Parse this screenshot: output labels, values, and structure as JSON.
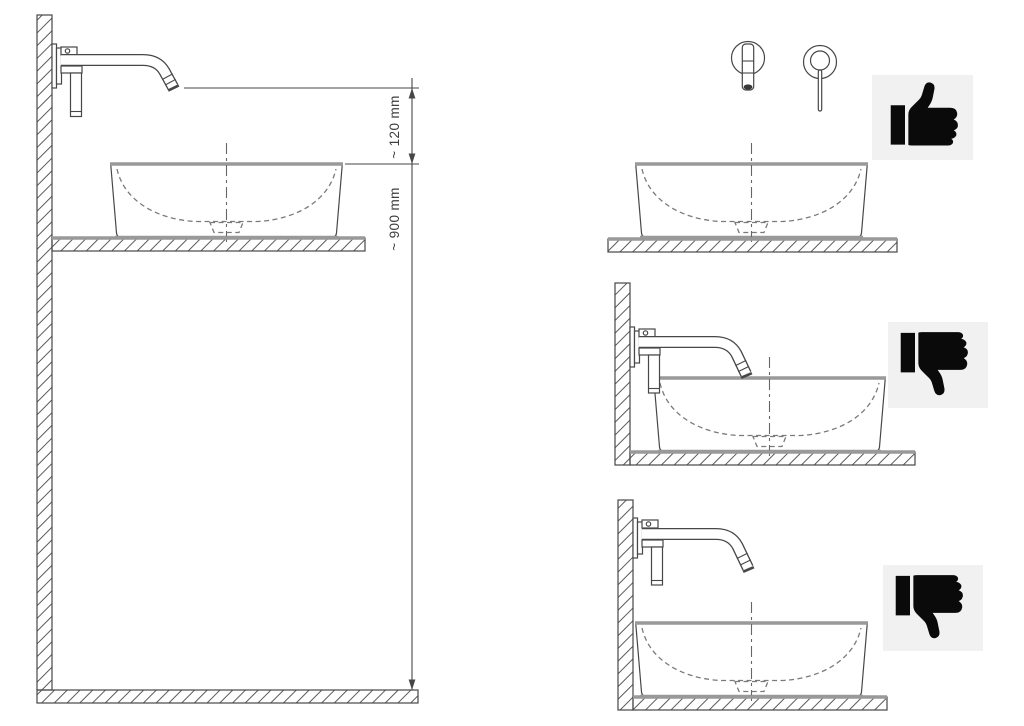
{
  "diagram": {
    "dimension_labels": {
      "spout_to_rim": "~ 120 mm",
      "rim_to_floor": "~ 900 mm"
    },
    "icons": {
      "front_view_panel": "thumbs-up",
      "spout_below_rim_panel": "thumbs-down",
      "spout_too_close_panel": "thumbs-down"
    },
    "colors": {
      "background": "#ffffff",
      "line": "#474747",
      "thick_edge": "#999999",
      "dashed": "#7a7a7a",
      "icon_background": "#f1f1f1",
      "icon_foreground": "#0a0a0a"
    }
  }
}
